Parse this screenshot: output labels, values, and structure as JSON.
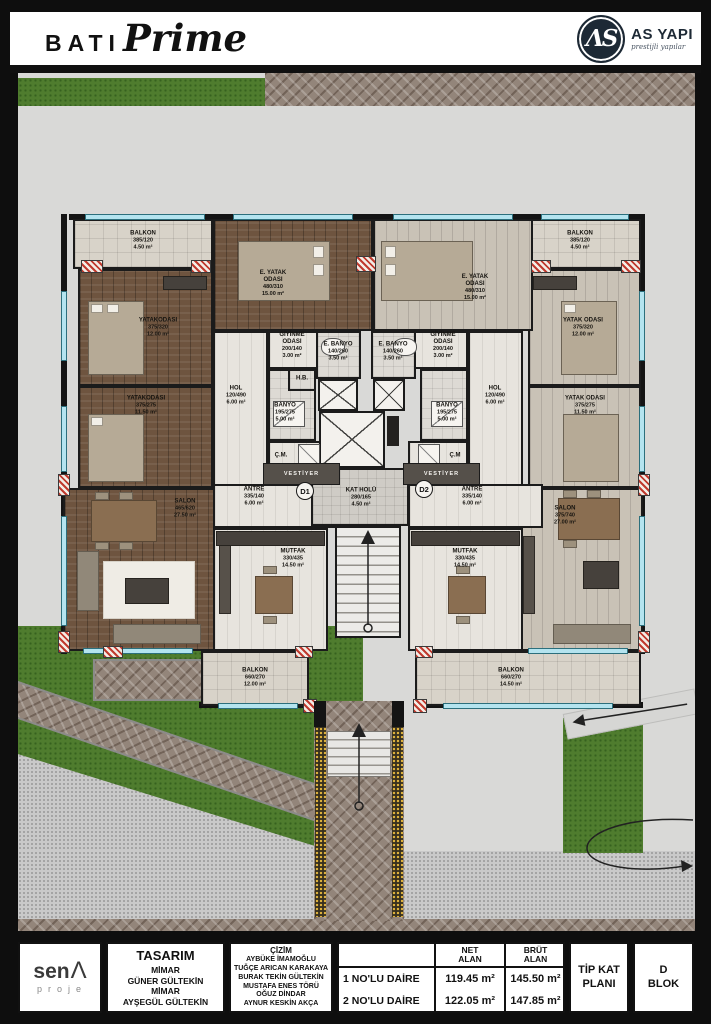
{
  "header": {
    "brand_primary": "BATI",
    "brand_script": "Prime",
    "logo_monogram": "ΛS",
    "logo_name": "AS YAPI",
    "logo_tagline": "prestijli yapılar"
  },
  "palette": {
    "brand_navy": "#1d2935",
    "grass_green": "#4f7c2e",
    "cobble_brown": "#93857a",
    "wall_black": "#141414",
    "window_cyan": "#b4e4ef",
    "pier_red": "#c03a2e"
  },
  "site": {
    "apartment1": {
      "balkon_ust": {
        "name": "BALKON",
        "dims": "385/120",
        "area": "4.50 m²"
      },
      "yatak1": {
        "name": "YATAKODASI",
        "dims": "375/320",
        "area": "12.00 m²"
      },
      "eyatak": {
        "name": "E. YATAK ODASI",
        "dims": "480/310",
        "area": "15.00 m²"
      },
      "giyinme": {
        "name": "GİYİNME ODASI",
        "dims": "200/140",
        "area": "3.00 m²"
      },
      "ebanyo": {
        "name": "E. BANYO",
        "dims": "140/260",
        "area": "3.50 m²"
      },
      "hb": "H.B.",
      "hol": {
        "name": "HOL",
        "dims": "120/490",
        "area": "6.00 m²"
      },
      "banyo": {
        "name": "BANYO",
        "dims": "195/275",
        "area": "5.00 m²"
      },
      "cm": "Ç.M.",
      "vestiyer": "VESTİYER",
      "antre": {
        "name": "ANTRE",
        "dims": "335/140",
        "area": "6.00 m²"
      },
      "yatak2": {
        "name": "YATAKODASI",
        "dims": "375/275",
        "area": "11.50 m²"
      },
      "salon": {
        "name": "SALON",
        "dims": "465/620",
        "area": "27.50 m²"
      },
      "mutfak": {
        "name": "MUTFAK",
        "dims": "330/435",
        "area": "14.50 m²"
      },
      "balkon_alt": {
        "name": "BALKON",
        "dims": "660/270",
        "area": "12.00 m²"
      },
      "kapi": "D1"
    },
    "apartment2": {
      "balkon_ust": {
        "name": "BALKON",
        "dims": "385/120",
        "area": "4.50 m²"
      },
      "yatak1": {
        "name": "YATAK ODASI",
        "dims": "375/320",
        "area": "12.00 m²"
      },
      "eyatak": {
        "name": "E. YATAK ODASI",
        "dims": "480/310",
        "area": "15.00 m²"
      },
      "giyinme": {
        "name": "GİYİNME ODASI",
        "dims": "200/140",
        "area": "3.00 m²"
      },
      "ebanyo": {
        "name": "E. BANYO",
        "dims": "140/260",
        "area": "3.50 m²"
      },
      "hol": {
        "name": "HOL",
        "dims": "120/490",
        "area": "6.00 m²"
      },
      "banyo": {
        "name": "BANYO",
        "dims": "195/275",
        "area": "5.00 m²"
      },
      "cm": "Ç.M",
      "vestiyer": "VESTİYER",
      "antre": {
        "name": "ANTRE",
        "dims": "335/140",
        "area": "6.00 m²"
      },
      "yatak2": {
        "name": "YATAK ODASI",
        "dims": "375/275",
        "area": "11.50 m²"
      },
      "salon": {
        "name": "SALON",
        "dims": "375/740",
        "area": "27.00 m²"
      },
      "mutfak": {
        "name": "MUTFAK",
        "dims": "330/435",
        "area": "14.50 m²"
      },
      "balkon_alt": {
        "name": "BALKON",
        "dims": "660/270",
        "area": "14.50 m²"
      },
      "kapi": "D2"
    },
    "core": {
      "kat_holu": {
        "name": "KAT HOLÜ",
        "dims": "280/165",
        "area": "4.50 m²"
      }
    }
  },
  "footer": {
    "sena": {
      "name": "sen",
      "mark": "Λ",
      "sub": "proje"
    },
    "tasarim": {
      "title": "TASARIM",
      "lines": [
        "MİMAR",
        "GÜNER GÜLTEKİN",
        "MİMAR",
        "AYŞEGÜL GÜLTEKİN"
      ]
    },
    "cizim": {
      "title": "ÇİZİM",
      "lines": [
        "AYBÜKE İMAMOĞLU",
        "TUĞÇE ARICAN KARAKAYA",
        "BURAK TEKİN GÜLTEKİN",
        "MUSTAFA ENES TÖRÜ",
        "OĞUZ DİNDAR",
        "AYNUR KESKİN AKÇA"
      ]
    },
    "table": {
      "col_net": "NET\nALAN",
      "col_brut": "BRÜT\nALAN",
      "rows": [
        {
          "label": "1 NO'LU DAİRE",
          "net": "119.45 m²",
          "brut": "145.50 m²"
        },
        {
          "label": "2 NO'LU DAİRE",
          "net": "122.05 m²",
          "brut": "147.85 m²"
        }
      ]
    },
    "tip_kat": "TİP KAT PLANI",
    "blok": "D BLOK"
  }
}
